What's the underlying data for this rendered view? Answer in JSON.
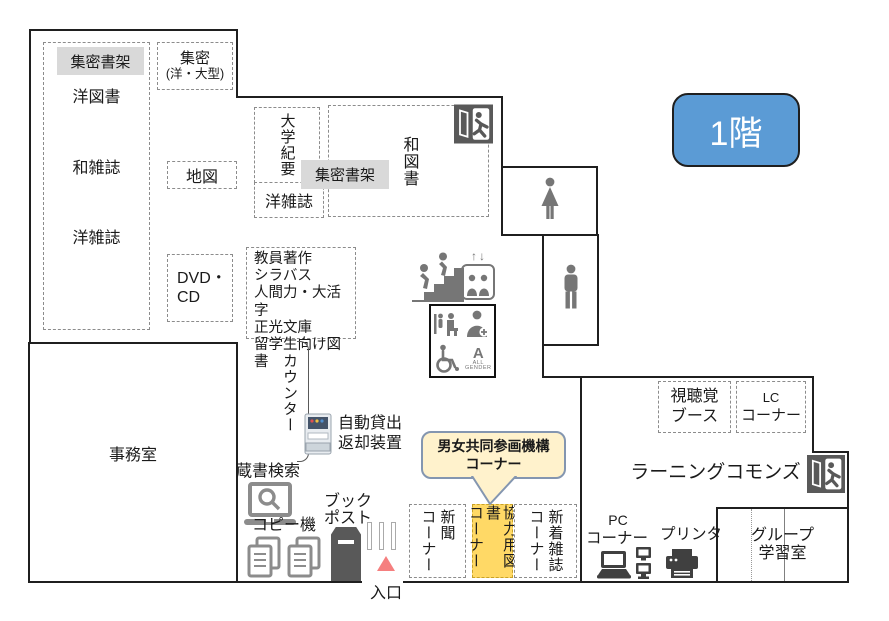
{
  "floor_badge": "1階",
  "stacks_left": {
    "dense_stacks": "集密書架",
    "western_books": "洋図書",
    "jp_magazines": "和雑誌",
    "western_magazines": "洋雑誌"
  },
  "dense_western_large": {
    "line1": "集密",
    "line2": "(洋・大型)"
  },
  "map_box": "地図",
  "dvd_cd": {
    "line1": "DVD・",
    "line2": "CD"
  },
  "univ_bulletin": "大学紀要",
  "western_magazines2": "洋雑誌",
  "jp_books": "和図書",
  "dense_stacks2": "集密書架",
  "faculty_box": {
    "lines": [
      "教員著作",
      "シラバス",
      "人間力・大活字",
      "正光文庫",
      "留学生向け図書"
    ]
  },
  "counter": "カウンター",
  "self_checkout": {
    "line1": "自動貸出",
    "line2": "返却装置"
  },
  "office": "事務室",
  "opac": "蔵書検索",
  "copier": "コピー機",
  "book_post": {
    "line1": "ブック",
    "line2": "ポスト"
  },
  "entrance": "入口",
  "gender_equality_callout": {
    "line1": "男女共同参画機構",
    "line2": "コーナー"
  },
  "newspaper_corner": {
    "line1": "新聞",
    "line2": "コーナー"
  },
  "cooperation_books_corner": {
    "line1": "協力用図書",
    "line2": "コーナー"
  },
  "new_magazines_corner": {
    "line1": "新着雑誌",
    "line2": "コーナー"
  },
  "av_booth": {
    "line1": "視聴覚",
    "line2": "ブース"
  },
  "lc_corner": {
    "line1": "LC",
    "line2": "コーナー"
  },
  "learning_commons": "ラーニングコモンズ",
  "pc_corner": {
    "line1": "PC",
    "line2": "コーナー"
  },
  "printer": "プリンタ",
  "group_study": {
    "line1": "グループ",
    "line2": "学習室"
  },
  "elevator_arrows": "↑↓",
  "all_gender": {
    "a": "A",
    "line1": "ALL",
    "line2": "GENDER"
  },
  "colors": {
    "floor_badge_blue": "#5B9BD5",
    "highlight_gray": "#D9D9D9",
    "highlight_orange": "#FFD966",
    "callout_cream": "#FFF2CC",
    "callout_border": "#8496B0",
    "entrance_pink": "#F57F7F",
    "icon_gray": "#767676"
  }
}
